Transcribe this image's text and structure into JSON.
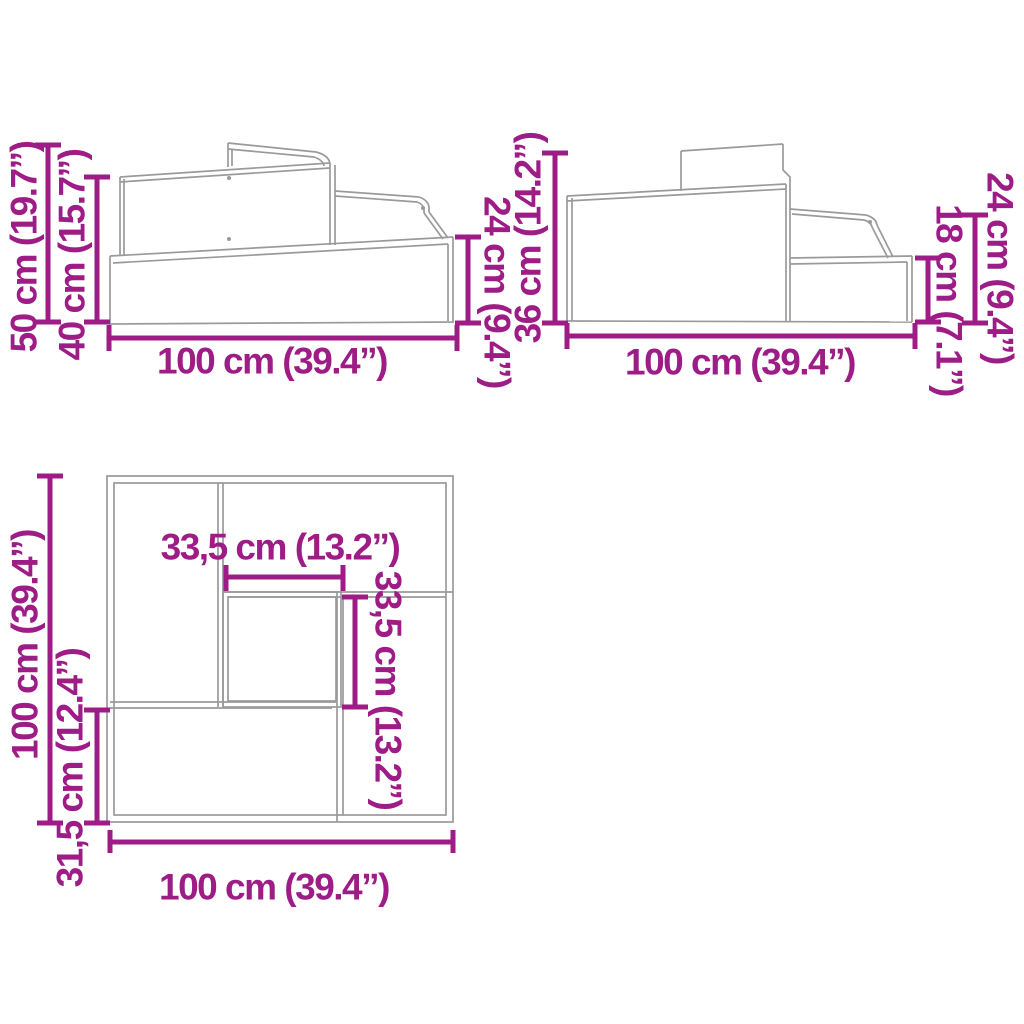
{
  "figure": {
    "type": "furniture-dimension-diagram",
    "subject": "three-tier corner raised bed / planter, three orthographic-perspective views"
  },
  "colors": {
    "dimension_accent": "#9E1C86",
    "drawing_lines": "#9A9A9A",
    "background": "#FFFFFF"
  },
  "views": {
    "side_view_left": {
      "dimensions": {
        "overall_height": "50 cm (19.7”)",
        "wall_height": "40 cm (15.7”)",
        "width": "100 cm (39.4”)",
        "right_height": "24 cm (9.4”)"
      }
    },
    "side_view_right": {
      "dimensions": {
        "left_height": "36 cm (14.2”)",
        "width": "100 cm (39.4”)",
        "step_height": "18 cm (7.1”)",
        "right_height": "24 cm (9.4”)"
      }
    },
    "top_view": {
      "dimensions": {
        "side_length": "100 cm (39.4”)",
        "lower_section_depth": "31,5 cm (12.4”)",
        "inner_box_width": "33,5 cm (13.2”)",
        "inner_box_depth": "33,5 cm (13.2”)",
        "bottom_width": "100 cm (39.4”)"
      }
    }
  }
}
